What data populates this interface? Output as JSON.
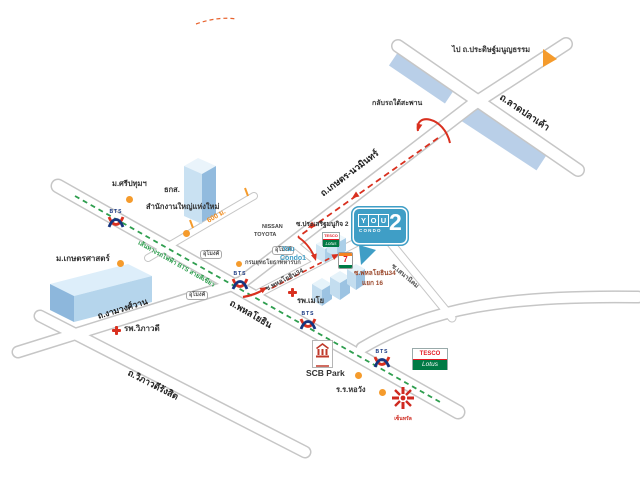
{
  "colors": {
    "route_red": "#d9301f",
    "bts_green": "#2f9e4f",
    "marker_orange": "#f59b2c",
    "expressway_blue": "#b9cfe8",
    "balloon_blue": "#3f9ec6",
    "tesco_green": "#007a45",
    "central_red": "#cf2a20",
    "road_border": "#c9c9c9"
  },
  "roads": {
    "phahonyothin": "ถ.พหลโยธิน",
    "kaset_nawamin": "ถ.เกษตร-นวมินทร์",
    "ngamwongwan": "ถ.งามวงศ์วาน",
    "vibhavadi_rangsit": "ถ.วิภาวดีรังสิต",
    "lat_pla_khao": "ถ.ลาดปลาเค้า",
    "to_pradit_manutham": "ไป ถ.ประดิษฐ์มนูญธรรม",
    "soi_prasert_manukit_2": "ซ.ประเสริฐมนูกิจ 2",
    "soi_phahonyothin_34": "ซ.พหลโยธิน34",
    "soi_phahonyothin_34_yaek16": {
      "line1": "ซ.พหลโยธิน34",
      "line2": "แยก 16"
    },
    "soi_sena_nikhom": "ซ.เสนานิคม"
  },
  "notes": {
    "u_turn_under_bridge": "กลับรถใต้สะพาน",
    "tunnel": "อุโมงค์",
    "bts_green_line": "เส้นทางรถไฟฟ้า BTS สายสีเขียว",
    "distance_600m": "600 ม."
  },
  "places": {
    "sripatum_university": "ม.ศรีปทุมฯ",
    "baac": {
      "line1": "ธกส.",
      "line2": "สำนักงานใหญ่แห่งใหม่"
    },
    "kasetsart_university": "ม.เกษตรศาสตร์",
    "army_engineer_dept": "กรมยุทธโยธาทหารบก",
    "nissan": "NISSAN",
    "toyota": "TOYOTA",
    "you_condo1": {
      "line1": "You",
      "line2": "Condo1"
    },
    "mayo_hospital": "รพ.เมโย",
    "vibhavadi_hospital": "รพ.วิภาวดี",
    "scb_park": "SCB Park",
    "horwang_school": "ร.ร.หอวัง",
    "central": "เซ็นทรัล"
  },
  "brands": {
    "you2": {
      "you_letters": [
        "Y",
        "O",
        "U"
      ],
      "number": "2",
      "condo": "CONDO"
    },
    "bts": "BTS",
    "tesco": "TESCO",
    "lotus": "Lotus",
    "seven": "7"
  }
}
